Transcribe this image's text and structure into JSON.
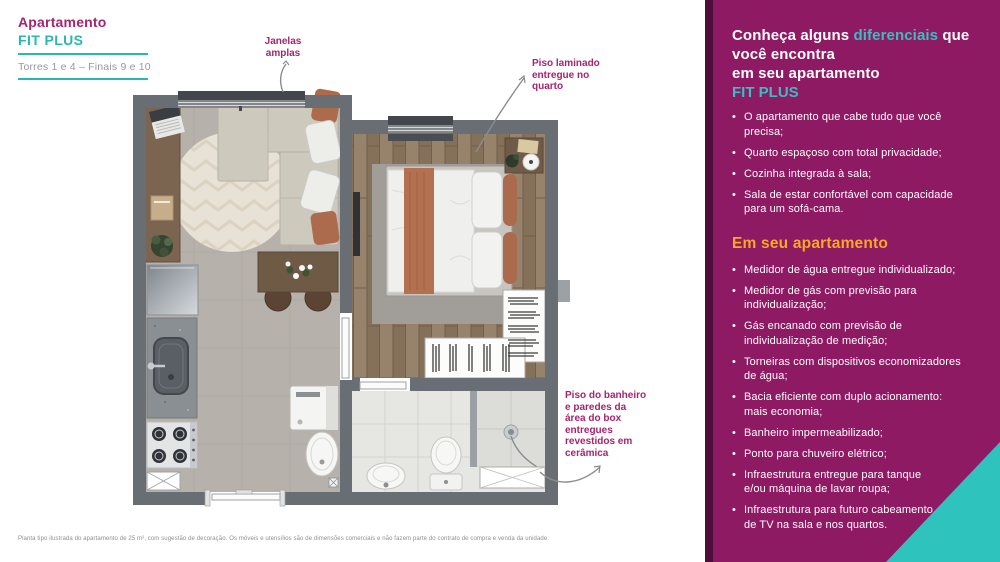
{
  "header": {
    "title": "Apartamento",
    "plan_name": "FIT PLUS",
    "towers": "Torres 1 e 4 – Finais 9 e 10"
  },
  "annotations": {
    "windows": "Janelas\namplas",
    "laminate": "Piso laminado\nentregue no\nquarto",
    "ceramic": "Piso do banheiro\ne paredes da\nárea do box\nentregues\nrevestidos em\ncerâmica"
  },
  "disclaimer": "Planta tipo ilustrada do apartamento de 25 m², com sugestão de decoração. Os móveis e utensílios são de dimensões comerciais e não fazem parte do contrato de compra e venda da unidade.",
  "panel": {
    "headline_pre": "Conheça alguns ",
    "headline_accent": "diferenciais",
    "headline_post": " que\nvocê encontra\nem seu apartamento",
    "plan_name": "FIT PLUS",
    "features": [
      "O apartamento que cabe tudo que você precisa;",
      "Quarto espaçoso com total privacidade;",
      "Cozinha integrada à sala;",
      "Sala de estar confortável com capacidade\npara um sofá-cama."
    ],
    "section2_title": "Em seu apartamento",
    "items": [
      "Medidor de água entregue individualizado;",
      "Medidor de gás com previsão para\nindividualização;",
      "Gás encanado com previsão de\nindividualização de medição;",
      "Torneiras com dispositivos economizadores\nde água;",
      "Bacia eficiente com duplo acionamento:\nmais economia;",
      "Banheiro impermeabilizado;",
      "Ponto para chuveiro elétrico;",
      "Infraestrutura entregue para tanque\ne/ou máquina de lavar roupa;",
      "Infraestrutura para futuro cabeamento\nde TV na sala e nos quartos."
    ]
  },
  "colors": {
    "panel_magenta": "#8E1A63",
    "panel_dark_strip": "#4E0D3B",
    "teal_accent": "#38BEC3",
    "teal_left": "#2BB7AF",
    "yellow_heading": "#F9A826",
    "annotation_magenta": "#A3256F",
    "corner_teal": "#2EC4BD",
    "wall_gray": "#696E74"
  }
}
